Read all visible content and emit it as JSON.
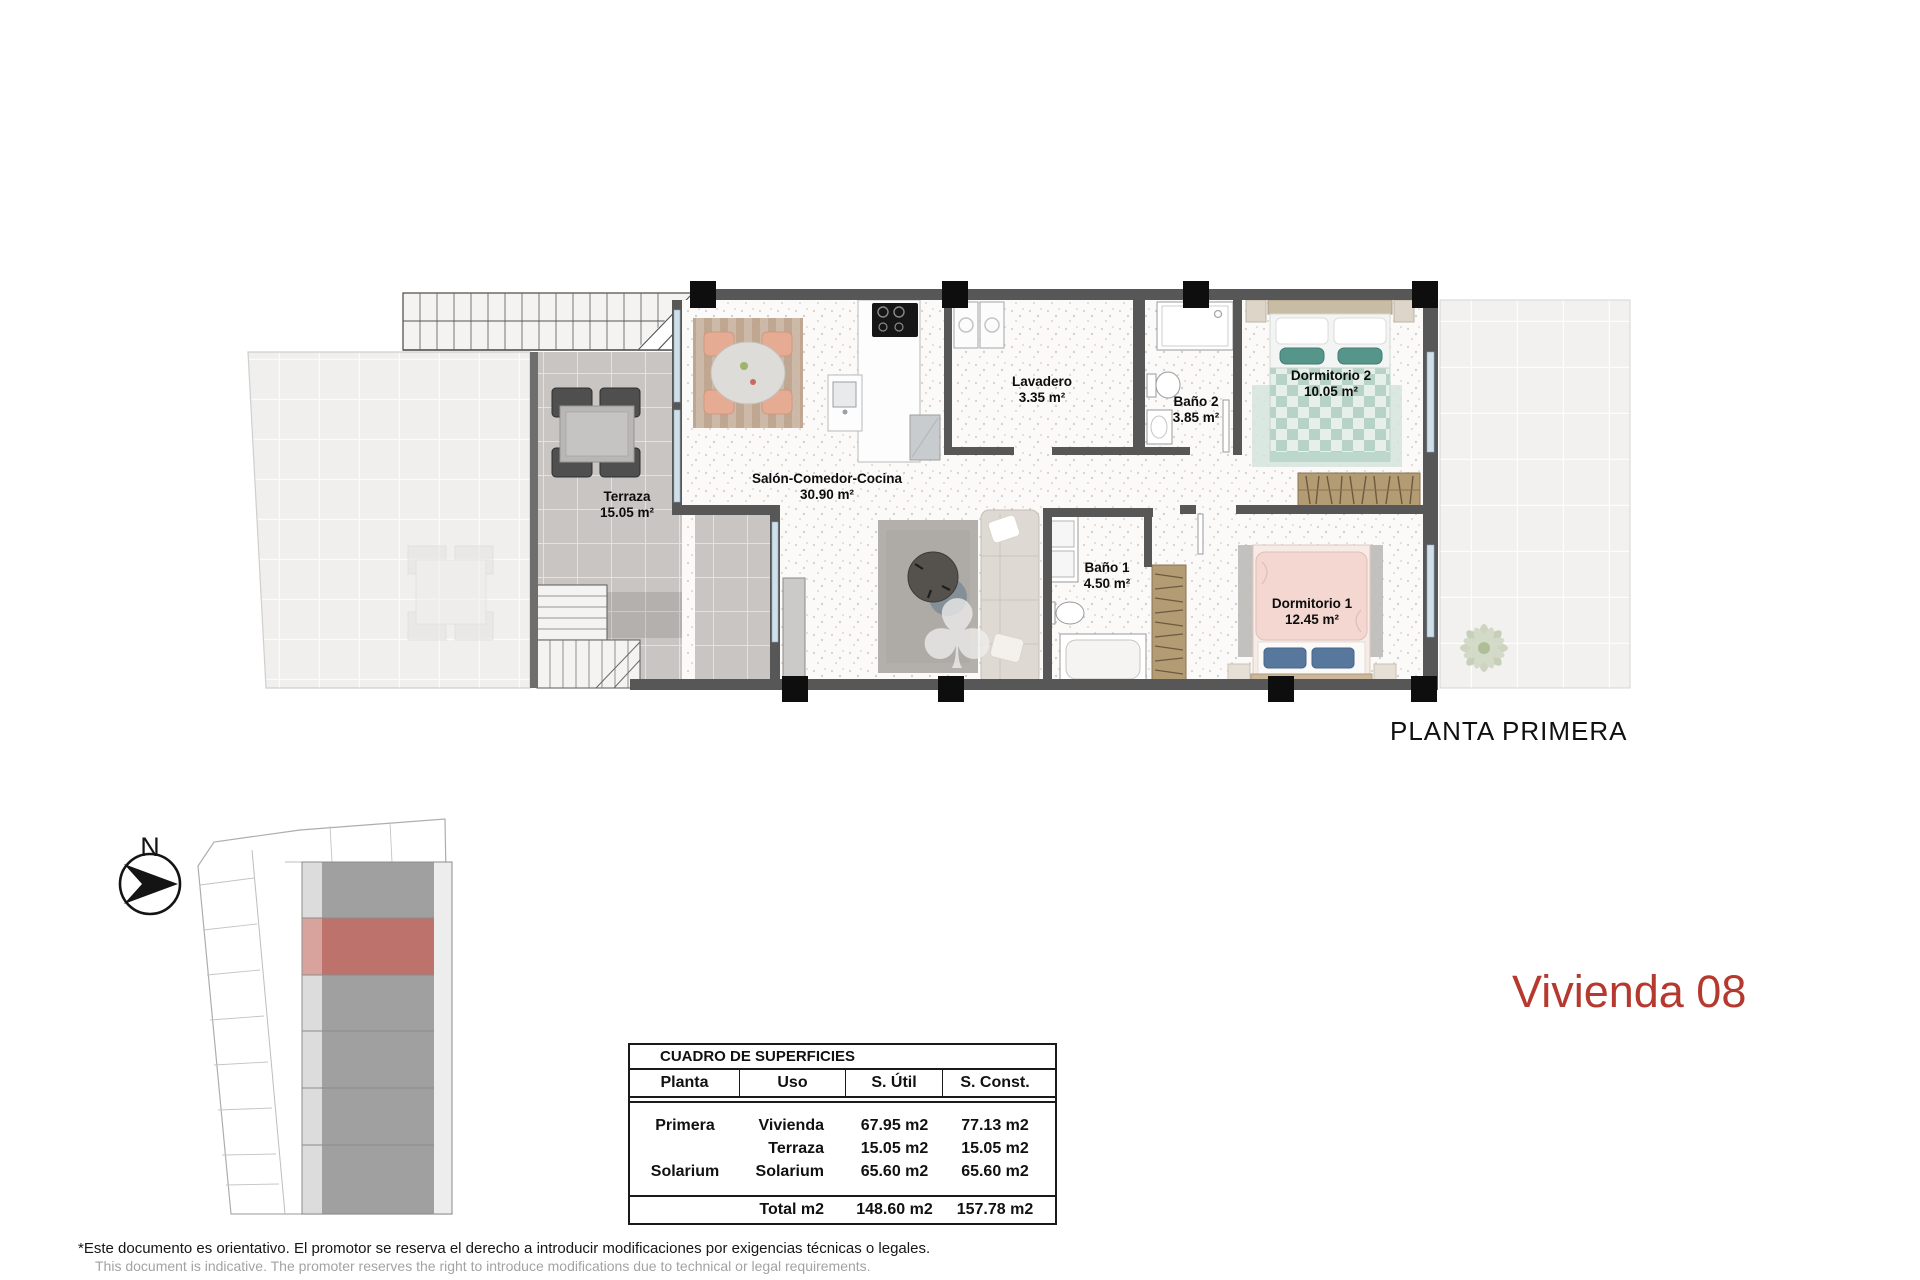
{
  "plan_caption": "PLANTA PRIMERA",
  "unit_title": "Vivienda 08",
  "compass": {
    "north_label": "N"
  },
  "rooms": {
    "terraza": {
      "name": "Terraza",
      "area": "15.05 m²"
    },
    "salon": {
      "name": "Salón-Comedor-Cocina",
      "area": "30.90 m²"
    },
    "lavadero": {
      "name": "Lavadero",
      "area": "3.35 m²"
    },
    "bano2": {
      "name": "Baño 2",
      "area": "3.85 m²"
    },
    "bano1": {
      "name": "Baño 1",
      "area": "4.50 m²"
    },
    "dormitorio2": {
      "name": "Dormitorio 2",
      "area": "10.05 m²"
    },
    "dormitorio1": {
      "name": "Dormitorio 1",
      "area": "12.45 m²"
    }
  },
  "surfaces_table": {
    "title": "CUADRO DE SUPERFICIES",
    "columns": [
      "Planta",
      "Uso",
      "S. Útil",
      "S. Const."
    ],
    "rows": [
      {
        "planta": "Primera",
        "uso": "Vivienda",
        "util": "67.95 m2",
        "const": "77.13 m2"
      },
      {
        "planta": "",
        "uso": "Terraza",
        "util": "15.05 m2",
        "const": "15.05 m2"
      },
      {
        "planta": "Solarium",
        "uso": "Solarium",
        "util": "65.60 m2",
        "const": "65.60 m2"
      }
    ],
    "total": {
      "label": "Total m2",
      "util": "148.60 m2",
      "const": "157.78 m2"
    }
  },
  "footer": {
    "line1": "*Este documento es orientativo. El promotor se reserva el derecho a introducir modificaciones por exigencias técnicas o legales.",
    "line2": "This document is indicative. The promoter reserves the right to introduce modifications due to technical or legal requirements."
  },
  "colors": {
    "accent_red": "#b5392e",
    "site_highlight": "#bd736c",
    "wall_gray": "#575757"
  }
}
